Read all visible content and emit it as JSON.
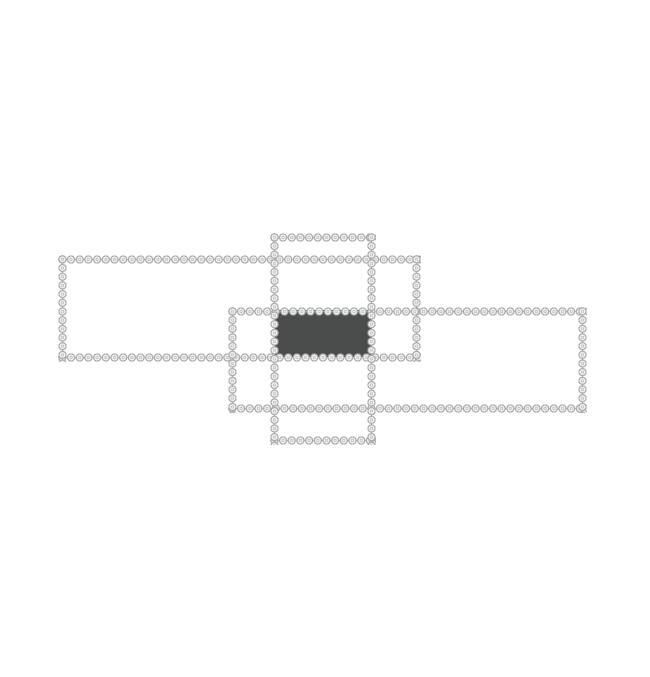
{
  "photo": {
    "subject": "Modern LED crystal ceiling chandelier seen flat-on: three overlapping rectangular frames fully lined with round crystal beads, with a dark rectangular mounting canopy at the centre, on a plain white background",
    "background_color": "#ffffff",
    "canvas": {
      "width": 650,
      "height": 677
    }
  },
  "fixture": {
    "bead_strip": {
      "thickness": 9,
      "bead_size": 8.7,
      "bead_outline_color": "#a9a9a9",
      "bead_body_color": "#f2f2f2",
      "bead_ring_color": "#b5b5b5",
      "bead_center_color": "#e9e9e9"
    },
    "frames": [
      {
        "name": "left-horizontal-frame",
        "left": 62,
        "top": 259,
        "right": 416,
        "bottom": 357
      },
      {
        "name": "right-horizontal-frame",
        "left": 232,
        "top": 311,
        "right": 582,
        "bottom": 408
      },
      {
        "name": "center-vertical-frame",
        "left": 274,
        "top": 237,
        "right": 371,
        "bottom": 440
      }
    ],
    "canopy": {
      "name": "ceiling-canopy",
      "left": 275,
      "top": 310,
      "width": 97,
      "height": 47,
      "color": "#4b4d4c"
    }
  }
}
